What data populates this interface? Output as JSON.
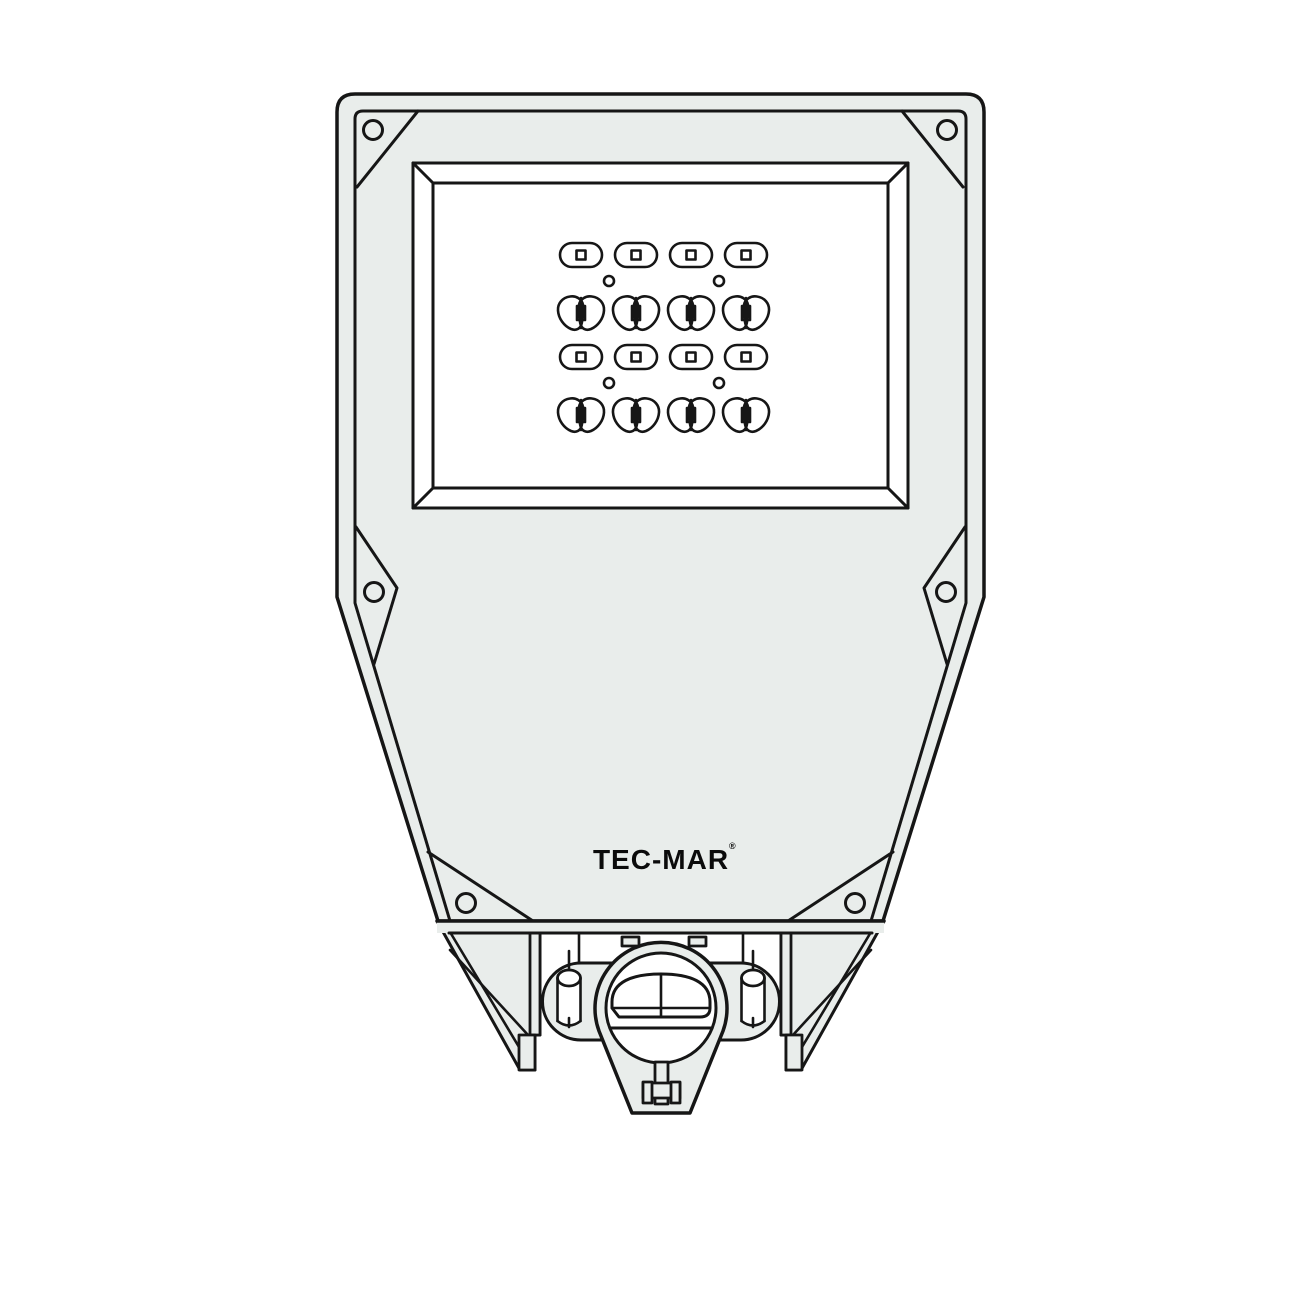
{
  "logo": {
    "text": "TEC-MAR",
    "mark": "®"
  },
  "colors": {
    "body_fill": "#e9edeb",
    "line": "#161616",
    "window_fill": "#ffffff",
    "background": "#ffffff"
  },
  "led_array": {
    "rows": [
      {
        "type": "oval",
        "count": 4
      },
      {
        "type": "butterfly",
        "count": 4
      },
      {
        "type": "oval",
        "count": 4
      },
      {
        "type": "butterfly",
        "count": 4
      }
    ],
    "pilot_holes": 4,
    "total_main_lenses": 16
  },
  "screw_holes": {
    "top_corners": 2,
    "side_ribs": 2,
    "lower_corners": 2
  }
}
